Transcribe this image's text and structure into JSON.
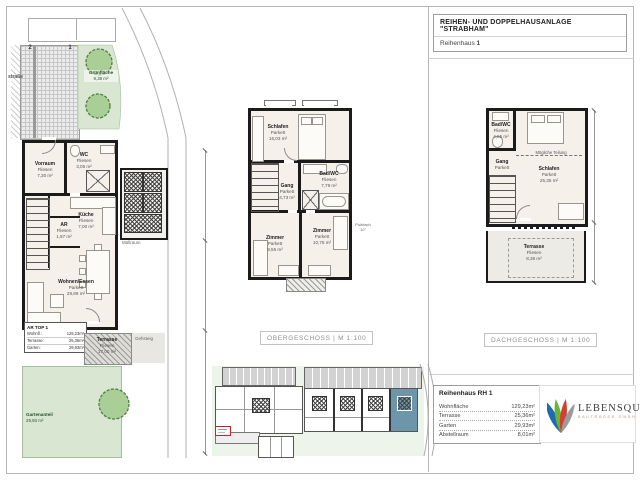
{
  "sheet": {
    "title": "REIHEN- UND DOPPELHAUSANLAGE \"STRABHAM\"",
    "subtitle": "Reihenhaus",
    "subtitle_number": "1"
  },
  "site_plan": {
    "street_label": "straße",
    "parking_numbers": [
      "2",
      "1"
    ],
    "gruenflaeche": {
      "name": "Grünfläche",
      "area": "9,38 m²"
    },
    "rooms": [
      {
        "name": "Vorraum",
        "floor": "Fliesen",
        "area": "7,30 m²"
      },
      {
        "name": "WC",
        "floor": "Fliesen",
        "area": "3,05 m²"
      },
      {
        "name": "Küche",
        "floor": "Fliesen",
        "area": "7,00 m²"
      },
      {
        "name": "AR",
        "floor": "Fliesen",
        "area": "1,97 m²"
      },
      {
        "name": "Wohnen/Essen",
        "floor": "Parkett",
        "area": "28,89 m²"
      }
    ],
    "muellraum_label": "Müllraum",
    "legend_box": {
      "title": "AR TOP 1",
      "rows": [
        {
          "label": "Wohnfl.:",
          "value": "129,23m²"
        },
        {
          "label": "Terrasse:",
          "value": "25,36m²"
        },
        {
          "label": "Garten:",
          "value": "29,93m²"
        }
      ]
    },
    "terrasse": {
      "name": "Terrasse",
      "floor": "Fliesen",
      "area": "17,00 m²"
    },
    "gehsteig_label": "Gehsteig",
    "garten": {
      "name": "Gartenanteil",
      "area": "29,93 m²"
    }
  },
  "og": {
    "caption": "OBERGESCHOSS | M 1:100",
    "rooms": [
      {
        "name": "Schlafen",
        "floor": "Parkett",
        "area": "16,03 m²"
      },
      {
        "name": "Bad/WC",
        "floor": "Fliesen",
        "area": "7,79 m²"
      },
      {
        "name": "Gang",
        "floor": "Parkett",
        "area": "4,73 m²"
      },
      {
        "name": "Zimmer",
        "floor": "Parkett",
        "area": "9,55 m²"
      },
      {
        "name": "Zimmer",
        "floor": "Parkett",
        "area": "10,75 m²"
      }
    ],
    "roof_note": {
      "line1": "Pultdach",
      "line2": "10°"
    }
  },
  "dg": {
    "caption": "DACHGESCHOSS | M 1:100",
    "teilung_label": "Mögliche Teilung",
    "rooms": [
      {
        "name": "Bad/WC",
        "floor": "Fliesen",
        "area": "4,55 m²"
      },
      {
        "name": "Gang",
        "floor": "Parkett",
        "area": ""
      },
      {
        "name": "Schlafen",
        "floor": "Parkett",
        "area": "25,35 m²"
      },
      {
        "name": "Terrasse",
        "floor": "Fliesen",
        "area": "8,36 m²"
      }
    ]
  },
  "info": {
    "title": "Reihenhaus RH 1",
    "rows": [
      {
        "label": "Wohnfläche",
        "value": "129,23m²"
      },
      {
        "label": "Terrasse",
        "value": "25,36m²"
      },
      {
        "label": "Garten",
        "value": "29,93m²"
      },
      {
        "label": "Abstellraum",
        "value": "8,01m²"
      }
    ]
  },
  "logo": {
    "name": "LEBENSQUELL",
    "subtitle": "BAUTRÄGER GMBH"
  },
  "colors": {
    "wall": "#1b1b1b",
    "floor": "#f5f1ea",
    "green": "#d9e7d2",
    "highlight_unit": "#6d96aa",
    "logo_blue": "#1e6cb0",
    "logo_green": "#69b43a",
    "logo_red": "#d2402f",
    "logo_gray": "#9b9b9b"
  }
}
